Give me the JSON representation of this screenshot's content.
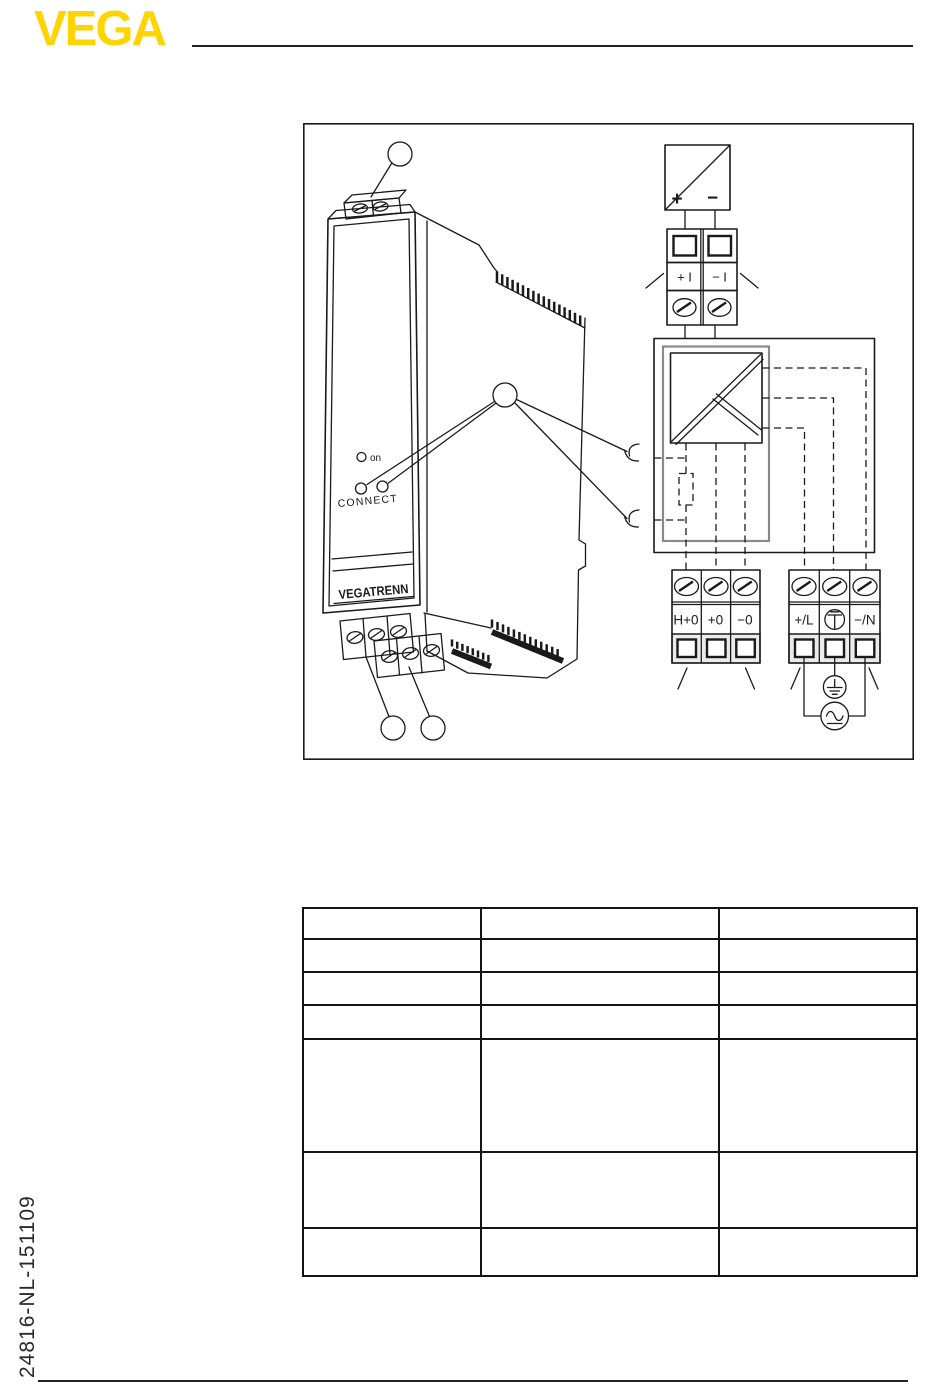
{
  "header": {
    "logo": "VEGA"
  },
  "sidebar": {
    "doc_number": "24816-NL-151109"
  },
  "colors": {
    "brand_yellow": "#FFD400",
    "ink": "#1a1a1a"
  },
  "figure": {
    "device": {
      "led_label": "on",
      "connect_label": "CONNECT",
      "nameplate": "VEGATRENN"
    },
    "schematic": {
      "sensor_plus": "+",
      "sensor_minus": "−",
      "signal_terminals": {
        "plus": "+ I",
        "minus": "− I"
      },
      "output_terminals": {
        "t1": "H+0",
        "t2": "+0",
        "t3": "−0"
      },
      "power_terminals": {
        "line": "+/L",
        "neutral": "−/N"
      }
    }
  },
  "table": {
    "cells": [
      [
        "",
        "",
        ""
      ],
      [
        "",
        "",
        ""
      ],
      [
        "",
        "",
        ""
      ],
      [
        "",
        "",
        ""
      ],
      [
        "",
        "",
        ""
      ],
      [
        "",
        "",
        ""
      ],
      [
        "",
        "",
        ""
      ]
    ]
  }
}
